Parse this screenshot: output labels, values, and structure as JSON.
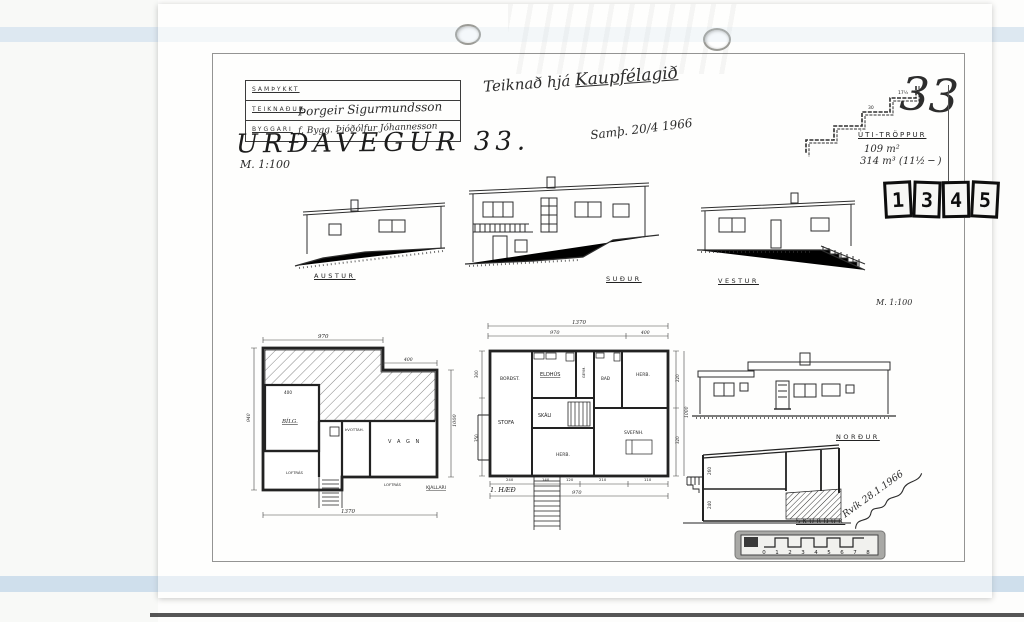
{
  "document": {
    "street_title": "URÐAVEGUR 33.",
    "scale_left": "M. 1:100",
    "scale_right": "M. 1:100",
    "dedication_prefix": "Teiknað hjá",
    "dedication_name": "Kaupfélagið",
    "approval_date": "Samþ. 20/4 1966",
    "plot_number": "33",
    "signature_date": "Rvík 28.1.1966"
  },
  "title_block": {
    "row1": "SAMÞYKKT",
    "row2_label": "TEIKNAÐUR",
    "row2_value": "Þorgeir Sigurmundsson",
    "row3_label": "BYGGARI",
    "row3_value": "f. Bygg. Þjóðólfur Jóhannesson"
  },
  "stair_detail": {
    "label": "ÚTI-TRÖPPUR",
    "area": "109 m²",
    "volume": "314 m³ (11½ ─ )",
    "dims": {
      "a": "17½",
      "b": "30"
    }
  },
  "stamp": {
    "digits": [
      "1",
      "3",
      "4",
      "5"
    ]
  },
  "elevations": {
    "east": "AUSTUR",
    "south": "SUÐUR",
    "west": "VESTUR",
    "north": "NORÐUR",
    "section": "SKURÐUR"
  },
  "basement_plan": {
    "name": "KJALLARI",
    "rooms": [
      {
        "label": "BÍLG."
      },
      {
        "label": "ÞVOTTAH."
      },
      {
        "label": "V A G N"
      }
    ],
    "notes": [
      "LOFTRÁS",
      "LOFTRÁS"
    ],
    "dims": {
      "top": "970",
      "bottom": "1370",
      "right": "1000",
      "left": "940",
      "garage": "400",
      "right_top": "400"
    }
  },
  "main_plan": {
    "name": "1. HÆÐ",
    "rooms": [
      {
        "label": "BORÐST."
      },
      {
        "label": "ELDHÚS"
      },
      {
        "label": "GEYM."
      },
      {
        "label": "BAÐ"
      },
      {
        "label": "HERB."
      },
      {
        "label": "SKÁLI"
      },
      {
        "label": "STOFA"
      },
      {
        "label": "HERB."
      },
      {
        "label": "SVEFNH."
      }
    ],
    "dims": {
      "total_top": "1370",
      "top_left": "970",
      "top_right": "400",
      "seg1": "240",
      "seg2": "140",
      "seg3": "120",
      "seg4": "210",
      "seg5": "110",
      "bottom_total": "970",
      "right_a": "220",
      "right_b": "320",
      "right_total": "1000",
      "left_a": "300",
      "left_b": "350"
    }
  },
  "section": {
    "dims": {
      "a": "240",
      "b": "260"
    }
  },
  "scale_bar": {
    "ticks": [
      "0",
      "1",
      "2",
      "3",
      "4",
      "5",
      "6",
      "7",
      "8"
    ]
  }
}
